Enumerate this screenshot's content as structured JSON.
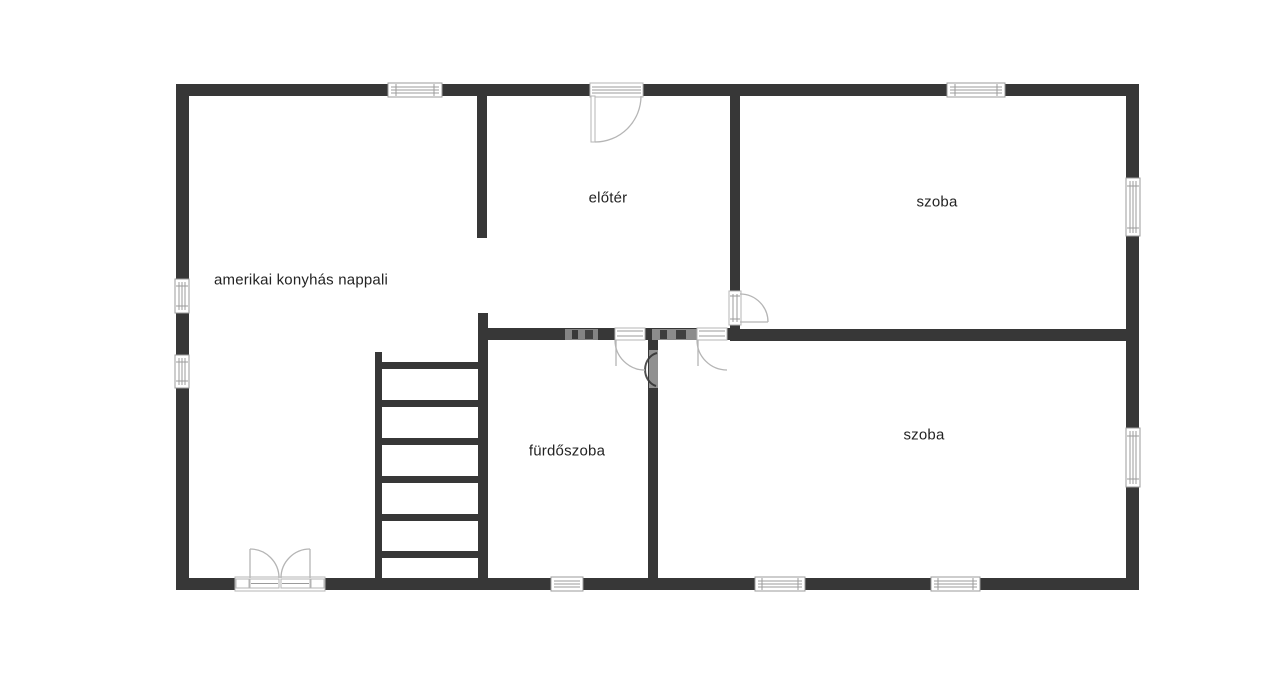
{
  "floorplan": {
    "rooms": [
      {
        "id": "living-room",
        "label": "amerikai konyhás nappali"
      },
      {
        "id": "hallway",
        "label": "előtér"
      },
      {
        "id": "room-top",
        "label": "szoba"
      },
      {
        "id": "bathroom",
        "label": "fürdőszoba"
      },
      {
        "id": "room-bottom",
        "label": "szoba"
      }
    ],
    "colors": {
      "wall": "#373737",
      "door_line": "#b5b5b5",
      "window_frame": "#9b9b9b",
      "label_text": "#232323",
      "background": "#ffffff",
      "watermark": "#949494"
    }
  }
}
